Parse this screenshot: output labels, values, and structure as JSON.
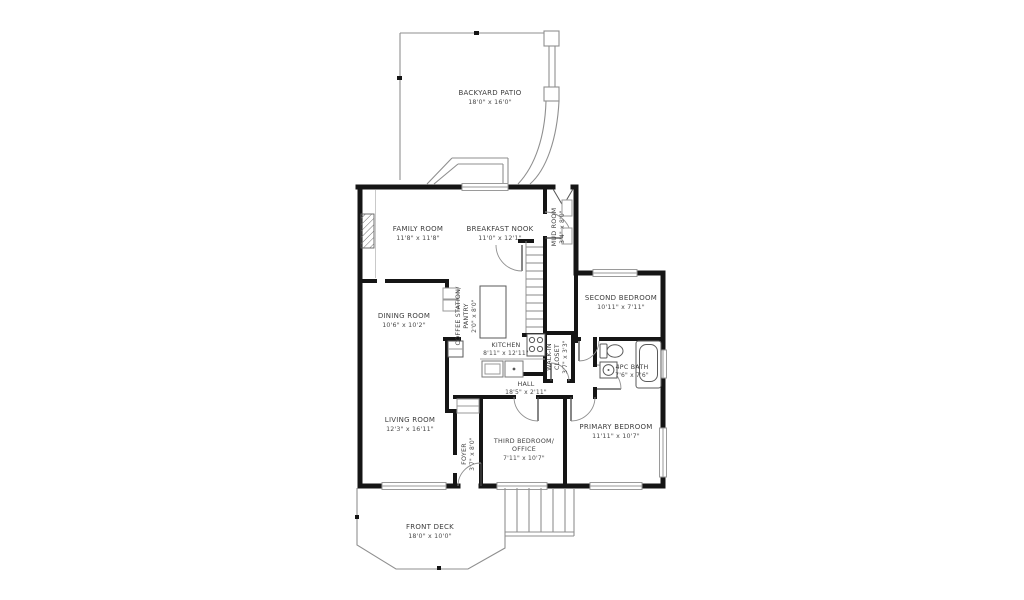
{
  "plan": {
    "title": "Main floor plan",
    "colors": {
      "background": "#ffffff",
      "wall": "#151515",
      "thin_line": "#8f8f8f",
      "window_line": "#9a9a9a",
      "label_text": "#3d3d3d"
    },
    "rooms": {
      "backyard_patio": {
        "name": "BACKYARD PATIO",
        "dims": "18'0\" x 16'0\""
      },
      "family_room": {
        "name": "FAMILY ROOM",
        "dims": "11'8\" x 11'8\""
      },
      "breakfast_nook": {
        "name": "BREAKFAST NOOK",
        "dims": "11'0\" x 12'1\""
      },
      "mud_room": {
        "name": "MUD ROOM",
        "dims": "3'4\" x 8'0\""
      },
      "second_bedroom": {
        "name": "SECOND BEDROOM",
        "dims": "10'11\" x 7'11\""
      },
      "dining_room": {
        "name": "DINING ROOM",
        "dims": "10'6\" x 10'2\""
      },
      "coffee_station": {
        "name": "COFFEE STATION/",
        "name2": "PANTRY",
        "dims": "2'0\" x 8'0\""
      },
      "kitchen": {
        "name": "KITCHEN",
        "dims": "8'11\" x 12'11\""
      },
      "walk_in_closet": {
        "name": "WALK-IN",
        "name2": "CLOSET",
        "dims": "3'7\" x 3'3\""
      },
      "bath": {
        "name": "4PC BATH",
        "dims": "7'6\" x 7'6\""
      },
      "hall": {
        "name": "HALL",
        "dims": "18'5\" x 2'11\""
      },
      "living_room": {
        "name": "LIVING ROOM",
        "dims": "12'3\" x 16'11\""
      },
      "foyer": {
        "name": "FOYER",
        "dims": "3'7\" x 8'0\""
      },
      "third_bedroom": {
        "name": "THIRD BEDROOM/",
        "name2": "OFFICE",
        "dims": "7'11\" x 10'7\""
      },
      "primary_bedroom": {
        "name": "PRIMARY BEDROOM",
        "dims": "11'11\" x 10'7\""
      },
      "front_deck": {
        "name": "FRONT DECK",
        "dims": "18'0\" x 10'0\""
      }
    }
  }
}
